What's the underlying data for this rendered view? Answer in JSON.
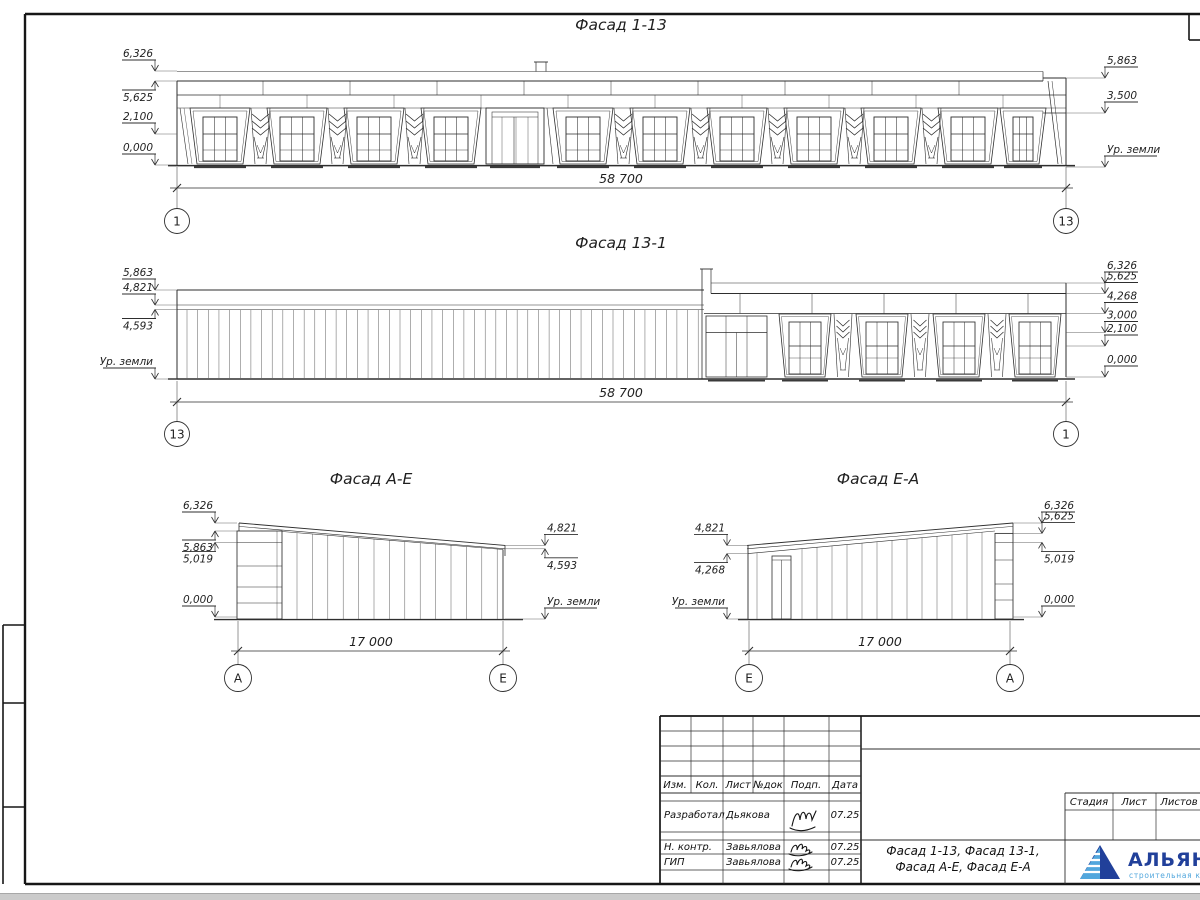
{
  "sheet": {
    "facades": [
      {
        "title": "Фасад 1-13",
        "dim": "58 700",
        "axis_left": "1",
        "axis_right": "13",
        "marks_left": [
          "6,326",
          "5,625",
          "2,100",
          "0,000"
        ],
        "marks_right": [
          "5,863",
          "3,500",
          "Ур. земли"
        ]
      },
      {
        "title": "Фасад 13-1",
        "dim": "58 700",
        "axis_left": "13",
        "axis_right": "1",
        "marks_left": [
          "5,863",
          "4,821",
          "4,593",
          "Ур. земли"
        ],
        "marks_right": [
          "6,326",
          "5,625",
          "4,268",
          "3,000",
          "2,100",
          "0,000"
        ]
      },
      {
        "title": "Фасад А-Е",
        "dim": "17 000",
        "axis_left": "А",
        "axis_right": "Е",
        "marks_left": [
          "6,326",
          "5,863",
          "5,019",
          "0,000"
        ],
        "marks_right": [
          "4,821",
          "4,593",
          "Ур. земли"
        ]
      },
      {
        "title": "Фасад Е-А",
        "dim": "17 000",
        "axis_left": "Е",
        "axis_right": "А",
        "marks_left": [
          "4,821",
          "4,268",
          "Ур. земли"
        ],
        "marks_right": [
          "6,326",
          "5,625",
          "5,019",
          "0,000"
        ]
      }
    ],
    "title_block": {
      "header_cols": [
        "Изм.",
        "Кол.",
        "Лист",
        "№док",
        "Подп.",
        "Дата"
      ],
      "rows": [
        {
          "role": "Разработал",
          "name": "Дьякова",
          "date": "07.25"
        },
        {
          "role": "Н. контр.",
          "name": "Завьялова",
          "date": "07.25"
        },
        {
          "role": "ГИП",
          "name": "Завьялова",
          "date": "07.25"
        }
      ],
      "doc_title_line1": "Фасад 1-13, Фасад 13-1,",
      "doc_title_line2": "Фасад А-Е, Фасад Е-А",
      "stage_cols": [
        "Стадия",
        "Лист",
        "Листов"
      ],
      "logo": {
        "name": "АЛЬЯНС",
        "tagline": "строительная компания",
        "navy": "#21409a",
        "light_blue": "#52a7dd"
      }
    }
  }
}
